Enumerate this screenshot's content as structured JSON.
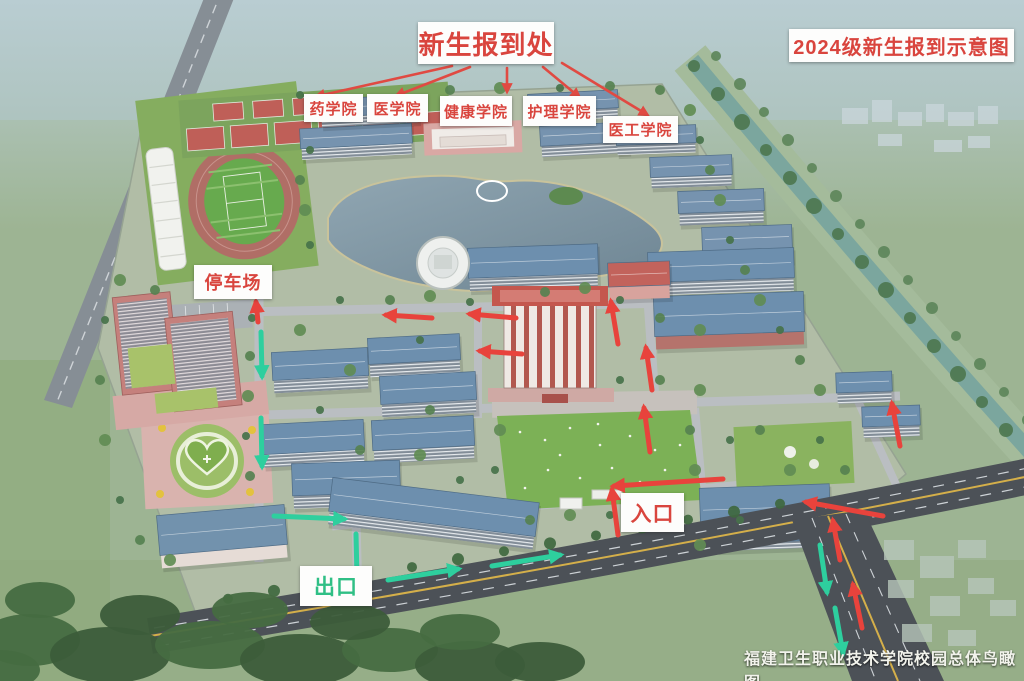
{
  "labels": {
    "registration_point": "新生报到处",
    "diagram_title": "2024级新生报到示意图",
    "colleges": [
      "药学院",
      "医学院",
      "健康学院",
      "护理学院",
      "医工学院"
    ],
    "parking": "停车场",
    "entrance": "入口",
    "exit": "出口",
    "caption": "福建卫生职业技术学院校园总体鸟瞰图"
  },
  "colors": {
    "label_text_red": "#d9453e",
    "exit_text_green": "#2fbf85",
    "entrance_route_red": "#e8433c",
    "exit_route_green": "#2ecf9e",
    "label_background": "#fdfdfc"
  }
}
